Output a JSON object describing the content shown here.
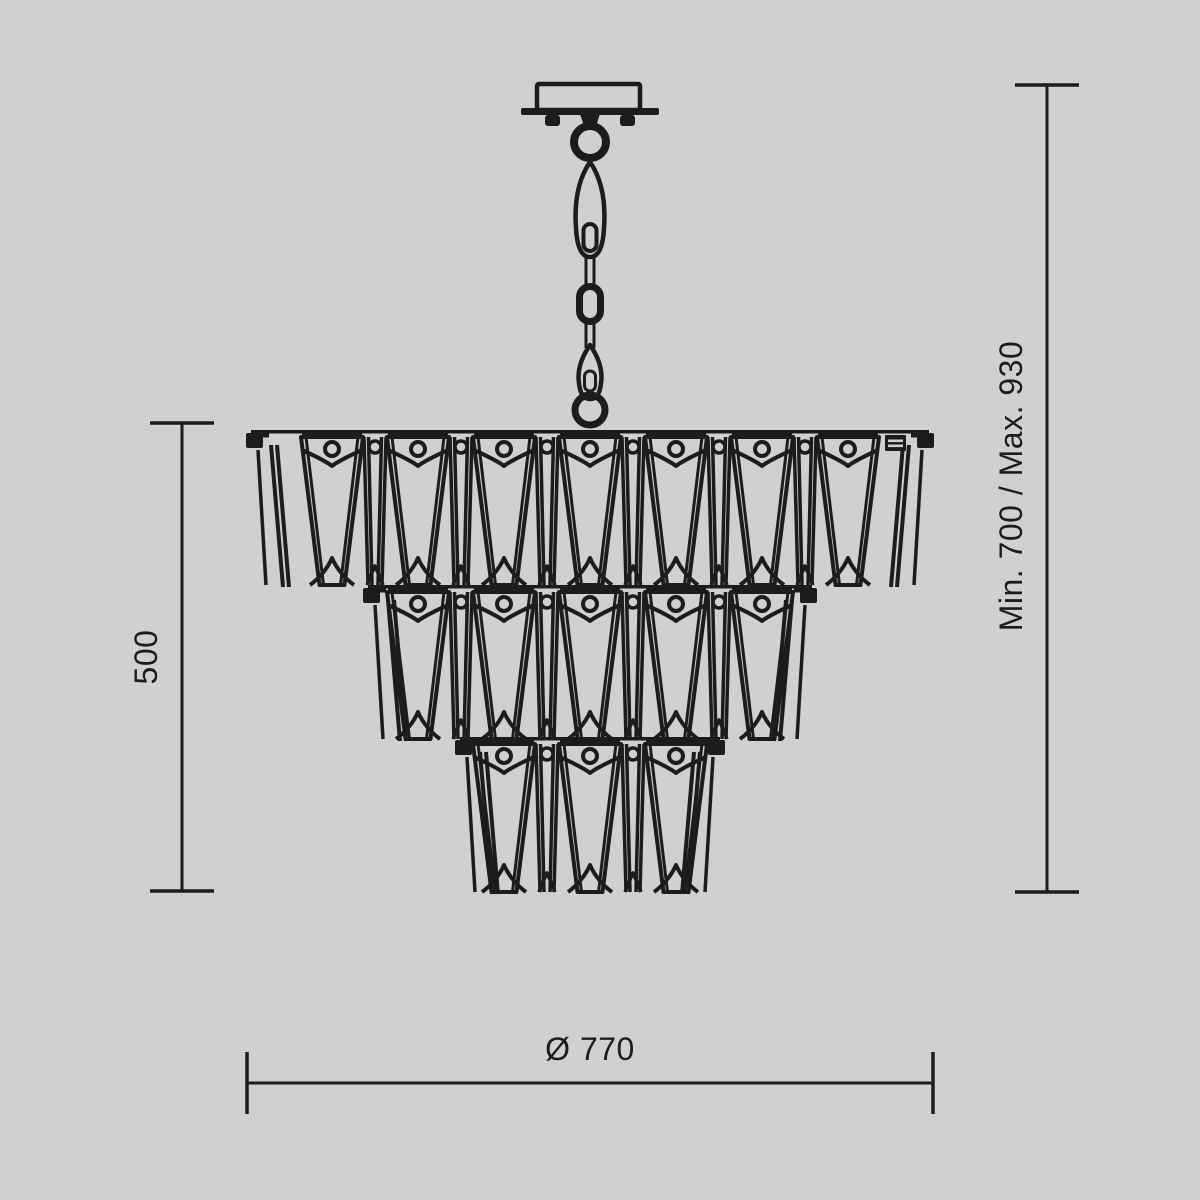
{
  "canvas": {
    "background": "#d0d0d0",
    "ink": "#1c1c1c"
  },
  "drawing": {
    "title": "chandelier-technical-dimension-drawing",
    "view": "front-elevation"
  },
  "labels": {
    "body_height": "500",
    "overall_height": "Min. 700 / Max. 930",
    "diameter": "Ø 770"
  },
  "chandelier": {
    "center_x": 590,
    "spacing": 86,
    "wide_top_halfwidth": 31,
    "wide_bottom_halfwidth": 12.5,
    "mount": {
      "canopy": {
        "x": 537,
        "y": 84,
        "w": 103,
        "h": 26
      },
      "plate": {
        "x": 521,
        "y": 108,
        "w": 138,
        "h": 7
      },
      "feet": [
        {
          "x": 545,
          "y": 115
        },
        {
          "x": 620,
          "y": 115
        }
      ],
      "foot_w": 15,
      "foot_h": 11
    },
    "chain": {
      "top_ring": {
        "cy": 142,
        "r": 16,
        "sw": 8
      },
      "teardrop_link": {
        "y1": 162,
        "y2": 257
      },
      "oval_link": {
        "y1": 283,
        "y2": 325
      },
      "hook_link": {
        "y1": 345,
        "y2": 399
      },
      "bottom_ring": {
        "cy": 410,
        "r": 15,
        "sw": 7
      }
    },
    "tiers": [
      {
        "name": "top",
        "bar_y": 430,
        "x1": 251,
        "x2": 929,
        "wide_count": 7,
        "crystal_h": 148,
        "adjuster": true
      },
      {
        "name": "middle",
        "bar_y": 585,
        "x1": 368,
        "x2": 812,
        "wide_count": 5,
        "crystal_h": 147,
        "adjuster": false
      },
      {
        "name": "bottom",
        "bar_y": 737,
        "x1": 460,
        "x2": 720,
        "wide_count": 3,
        "crystal_h": 148,
        "adjuster": false
      }
    ]
  },
  "dimensions": {
    "left": {
      "x": 182,
      "y1": 423,
      "y2": 891,
      "cap_half": 32,
      "label_x": 146,
      "label_y": 657
    },
    "right": {
      "x": 1047,
      "y1": 85,
      "y2": 892,
      "cap_half": 32,
      "label_x": 1011,
      "label_y": 486
    },
    "bottom": {
      "y": 1083,
      "x1": 247,
      "x2": 933,
      "cap_half": 31,
      "label_x": 590,
      "label_y": 1060
    }
  }
}
